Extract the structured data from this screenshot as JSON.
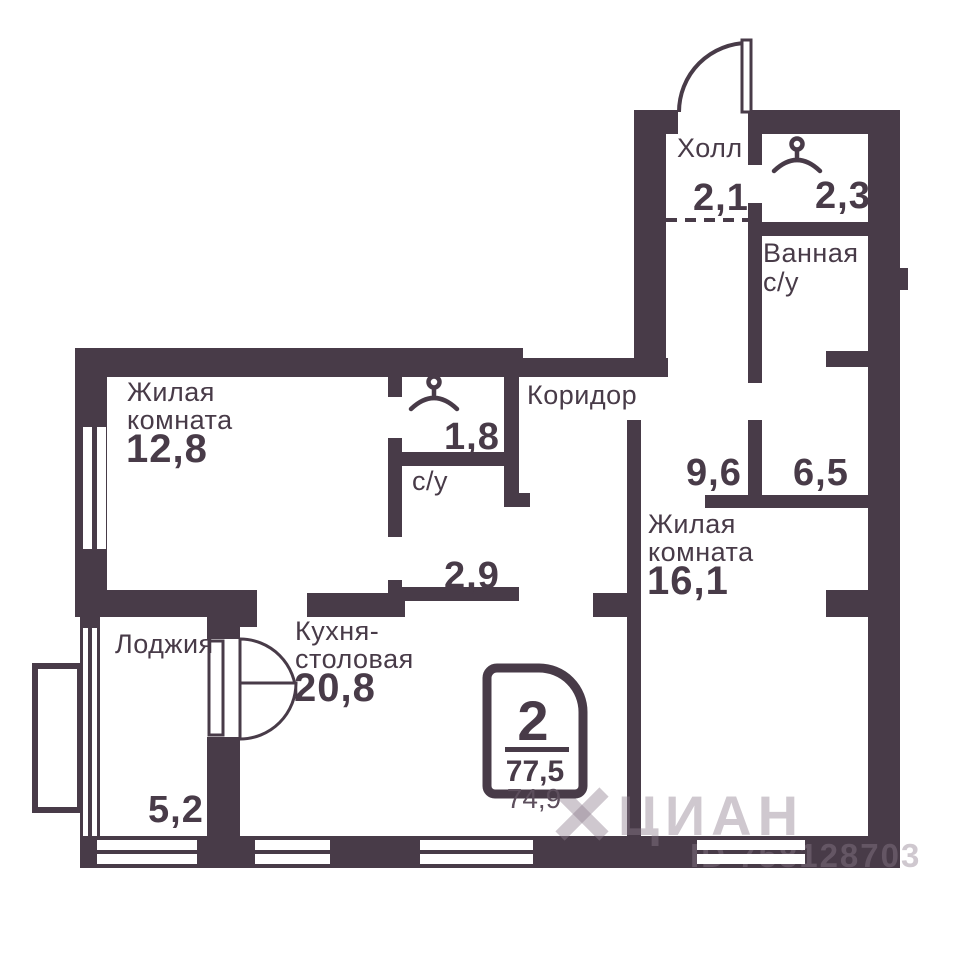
{
  "plan": {
    "colors": {
      "wall": "#483B48",
      "background": "#ffffff"
    },
    "rooms": {
      "hall": {
        "name": "Холл",
        "area": "2,1"
      },
      "wardrobe_hall": {
        "area": "2,3"
      },
      "bathroom": {
        "name_line1": "Ванная",
        "name_line2": "с/у"
      },
      "living1": {
        "name_line1": "Жилая",
        "name_line2": "комната",
        "area": "12,8"
      },
      "wardrobe_suite": {
        "area": "1,8"
      },
      "su": {
        "name": "с/у",
        "area": "2,9"
      },
      "corridor": {
        "name": "Коридор",
        "area": "9,6"
      },
      "storage": {
        "area": "6,5"
      },
      "living2": {
        "name_line1": "Жилая",
        "name_line2": "комната",
        "area": "16,1"
      },
      "kitchen": {
        "name_line1": "Кухня-",
        "name_line2": "столовая",
        "area": "20,8"
      },
      "loggia": {
        "name": "Лоджия",
        "area": "5,2"
      }
    },
    "badge": {
      "rooms": "2",
      "area_total": "77,5",
      "area_living": "74,9"
    },
    "watermark": {
      "brand": "ЦИАН",
      "id": "ID 758128703"
    }
  }
}
